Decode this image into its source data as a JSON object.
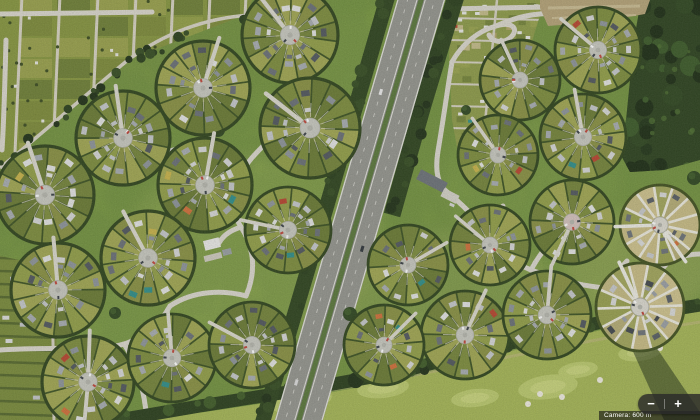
{
  "app": {
    "view": "satellite-aerial-view"
  },
  "map_controls": {
    "zoom_out_label": "−",
    "zoom_in_label": "+"
  },
  "attribution": {
    "text": "Camera: 600 m"
  },
  "palette": {
    "grass_base": "#7e9f40",
    "std": {
      "base": "#81913f",
      "wedges": [
        "#7e8e3d",
        "#93a048",
        "#6b7c34",
        "#a2a852",
        "#8a9243",
        "#75853a"
      ],
      "hedge": "#3c5222",
      "ring": "#2f441c",
      "plaza": "#c9cac1",
      "path": "#dcdacf",
      "inner": "rgba(224,220,198,0.7)",
      "houses": [
        "#c6c9cc",
        "#a8adb2",
        "#6a7077",
        "#e4e5e4",
        "#8e959b",
        "#51575e",
        "#d7d8d8"
      ],
      "accents": [
        "#b8452f",
        "#d2703a",
        "#2f8f8a",
        "#c9b44a"
      ]
    },
    "light": {
      "base": "#a8a468",
      "wedges": [
        "#b6ae76",
        "#c4ba82",
        "#a3a75c",
        "#d0c48e",
        "#99a150",
        "#c9bd85"
      ],
      "hedge": "#5a6a2e",
      "ring": "#41511f",
      "plaza": "#dcdad0",
      "path": "#eeede5",
      "spoke": "#edebdf",
      "inner": "rgba(238,235,223,0.8)",
      "houses": [
        "#585e64",
        "#9ba0a5",
        "#dadbda",
        "#42484e",
        "#c8cacc",
        "#6d7378"
      ],
      "accents": [
        "#b8452f",
        "#d2703a",
        "#2f8f8a"
      ]
    },
    "forest_base": "#2c421e",
    "forest_blobs": [
      "#223619",
      "#2f4720",
      "#3b5a28",
      "#1c2d14"
    ],
    "forest_light": "#4e7030",
    "tree_dark": [
      "#2a3f1c",
      "#354d22",
      "#203117"
    ],
    "road": "#dcd9cf",
    "asphalt": "#8c8d87",
    "lane": "#95968f",
    "median": "#5a783b",
    "white_line": "#e3e3dc",
    "dash_line": "#cfcfc8",
    "golf_base": "#a6b756",
    "golf_green": "#bccb6e",
    "golf_green_in": "#c9d57c",
    "bunker": "#f0ede1",
    "dirt": "#b6a478",
    "dirt_stripe": "#cbbd93",
    "shadow": "rgba(22,38,16,0.5)"
  },
  "scene": {
    "grass_patches": [
      [
        255,
        245,
        130,
        90,
        "#9cb553",
        0.55
      ],
      [
        450,
        300,
        110,
        70,
        "#a3b65a",
        0.5
      ],
      [
        640,
        265,
        75,
        55,
        "#b0bd60",
        0.6
      ],
      [
        90,
        330,
        80,
        50,
        "#8fae4b",
        0.5
      ],
      [
        530,
        180,
        90,
        60,
        "#8cab4a",
        0.45
      ],
      [
        170,
        60,
        120,
        50,
        "#7f9c40",
        0.4
      ],
      [
        620,
        390,
        90,
        40,
        "#9fb254",
        0.5
      ],
      [
        360,
        60,
        60,
        45,
        "#88a746",
        0.45
      ]
    ],
    "allotment_west": {
      "clip": "0,0 252,0 247,14 128,60 0,168",
      "cols": [
        16,
        54,
        92,
        130,
        167,
        204,
        240
      ],
      "row_step": 21,
      "plot_colors": [
        "#7e8c3a",
        "#93a047",
        "#6f8036",
        "#9aa24c",
        "#86953f"
      ],
      "base": "#87973f",
      "path_color": "#d8d4c4",
      "dot_color": "#3b4c20",
      "seed": 71
    },
    "allotment_east": {
      "clip": "452,0 545,0 536,28 518,90 500,150 488,172 462,174 452,120 449,55",
      "bbox": [
        449,
        0,
        96,
        174
      ],
      "hpaths": [
        18,
        40,
        62,
        84,
        106,
        128,
        150
      ],
      "base": "#8e9c49",
      "path_color": "#d6d2c2",
      "plot_colors": [
        "#75853a",
        "#99a44e",
        "#b4a86c",
        "#8a9847",
        "#c5bd8a",
        "#6d7c36"
      ],
      "roof_color": "#e9eae6",
      "seed": 72
    },
    "allotment_sw": {
      "clip": "0,256 48,266 56,300 58,420 0,420",
      "base": "#7a8c3b",
      "line_color": "#55682c",
      "seed": 73
    },
    "nw_corner": {
      "clip": "0,0 56,0 50,46 0,50",
      "base": "#5f7535",
      "seed": 74,
      "roofs": [
        [
          9,
          7,
          -10
        ],
        [
          25,
          5,
          8
        ],
        [
          41,
          9,
          -5
        ],
        [
          13,
          27,
          12
        ],
        [
          31,
          23,
          -8
        ]
      ]
    },
    "boundary_road": {
      "d": "M0,168 C46,130 96,86 128,60 C166,32 206,18 250,15",
      "pts": [
        [
          0,
          168
        ],
        [
          64,
          118
        ],
        [
          128,
          60
        ],
        [
          190,
          32
        ],
        [
          250,
          15
        ]
      ],
      "seed": 75
    },
    "roads_west": [
      "M0,350 C56,346 98,352 124,344 C152,335 162,320 170,306",
      "M124,344 C136,362 144,388 147,420",
      "M170,306 C194,290 224,290 246,296",
      "M246,296 C258,268 252,244 241,227 C231,211 229,196 236,181 C244,165 257,152 267,142 C277,130 279,112 271,97",
      "M241,227 C232,230 224,234 219,243",
      "M6,40 C5,80 4,120 2,150",
      "M152,12 L0,14"
    ],
    "roads_east": [
      "M452,62 C462,44 478,31 496,26 C511,21 519,28 512,36 C505,44 493,43 489,35",
      "M496,26 C520,15 545,11 566,15",
      "M452,62 C447,92 443,122 438,151 C435,170 437,184 447,192",
      "M447,192 C463,205 475,217 485,231 C497,249 511,262 531,270 C557,280 589,288 613,288 C637,288 656,277 669,261",
      "M531,270 C541,251 553,239 565,233",
      "M613,288 C616,276 621,267 627,261",
      "M485,231 C492,222 498,214 503,206",
      "M669,261 C681,256 692,254 700,254",
      "M447,9 L549,7"
    ],
    "tree_band": {
      "pts": [
        [
          112,
          421
        ],
        [
          200,
          406
        ],
        [
          300,
          390
        ],
        [
          400,
          372
        ],
        [
          466,
          354
        ],
        [
          540,
          336
        ],
        [
          620,
          318
        ],
        [
          700,
          305
        ]
      ],
      "w": 13,
      "seed": 76
    },
    "highway": {
      "x1": 424,
      "y1": -10,
      "x2": 296,
      "y2": 430,
      "west_strip": [
        [
          391,
          -15
        ],
        [
          327,
          205
        ],
        [
          262,
          424
        ]
      ],
      "east_strip": [
        [
          456,
          -4
        ],
        [
          423,
          105
        ],
        [
          392,
          215
        ]
      ],
      "seed": 77,
      "cars": [
        [
          0.24,
          -13,
          "#eeeeee"
        ],
        [
          0.58,
          13,
          "#2f353b"
        ],
        [
          0.9,
          -13,
          "#dddddd"
        ]
      ]
    },
    "forest": {
      "poly": "641,0 700,0 700,160 664,170 630,172 618,150 626,120 630,80 634,40",
      "bbox": [
        596,
        0,
        104,
        176
      ],
      "seed": 78
    },
    "dirt": {
      "poly": "540,0 650,0 645,14 600,22 548,26 540,8"
    },
    "tree_clumps": [
      [
        218,
        130,
        7
      ],
      [
        115,
        313,
        6
      ],
      [
        350,
        314,
        7
      ],
      [
        466,
        110,
        5
      ],
      [
        694,
        178,
        7
      ]
    ],
    "golf": {
      "poly": "104,420 205,412 305,397 405,379 470,361 545,343 623,325 700,311 700,420",
      "greens": [
        [
          300,
          400,
          32,
          13,
          -8
        ],
        [
          383,
          388,
          26,
          10,
          -6
        ],
        [
          548,
          387,
          30,
          12,
          -8
        ],
        [
          578,
          370,
          20,
          8,
          -8
        ],
        [
          640,
          352,
          22,
          9,
          -8
        ],
        [
          475,
          398,
          24,
          9,
          -6
        ]
      ],
      "bunkers": [
        [
          283,
          397
        ],
        [
          318,
          408
        ],
        [
          528,
          404
        ],
        [
          540,
          394
        ],
        [
          562,
          397
        ],
        [
          600,
          380
        ],
        [
          660,
          348
        ]
      ],
      "shadow_poly": "630,345 652,341 700,412 700,420 664,420",
      "sand_path": "M180,412 C260,402 340,390 430,372 C520,355 600,338 700,322"
    },
    "buildings": [
      [
        190,
        146,
        46,
        7,
        -17,
        "#dcdcd8"
      ],
      [
        196,
        156,
        40,
        6,
        -17,
        "#c3c5c7"
      ],
      [
        212,
        244,
        16,
        10,
        -14,
        "#ebebe9"
      ],
      [
        227,
        252,
        9,
        6,
        -14,
        "#9aa0a4"
      ],
      [
        213,
        257,
        18,
        6,
        -14,
        "#cfccc0"
      ],
      [
        432,
        181,
        30,
        11,
        27,
        "#6d7379"
      ],
      [
        450,
        196,
        17,
        9,
        27,
        "#d5d3c9"
      ]
    ],
    "cars": [
      [
        536,
        299,
        -10,
        "#ffffff"
      ],
      [
        560,
        287,
        -15,
        "#e8e8e8"
      ],
      [
        452,
        205,
        25,
        "#d8d8d8"
      ]
    ],
    "circles": [
      {
        "id": "w1",
        "cx": 203,
        "cy": 88,
        "r": 47,
        "style": "std",
        "seed": 11,
        "paths": [
          -72
        ]
      },
      {
        "id": "w2",
        "cx": 290,
        "cy": 35,
        "r": 48,
        "style": "std",
        "seed": 12,
        "paths": [
          -128
        ]
      },
      {
        "id": "w3",
        "cx": 123,
        "cy": 138,
        "r": 47,
        "style": "std",
        "seed": 13,
        "paths": [
          -98
        ]
      },
      {
        "id": "w4",
        "cx": 45,
        "cy": 195,
        "r": 49,
        "style": "std",
        "seed": 14,
        "paths": [
          -108
        ]
      },
      {
        "id": "w5",
        "cx": 205,
        "cy": 185,
        "r": 47,
        "style": "std",
        "seed": 15,
        "paths": [
          -80
        ]
      },
      {
        "id": "w6",
        "cx": 310,
        "cy": 128,
        "r": 50,
        "style": "std",
        "seed": 16,
        "paths": [
          -142
        ]
      },
      {
        "id": "w7",
        "cx": 148,
        "cy": 258,
        "r": 47,
        "style": "std",
        "seed": 17,
        "paths": [
          -118
        ]
      },
      {
        "id": "w8",
        "cx": 58,
        "cy": 290,
        "r": 47,
        "style": "std",
        "seed": 18,
        "paths": [
          -95
        ]
      },
      {
        "id": "w9",
        "cx": 88,
        "cy": 382,
        "r": 46,
        "style": "std",
        "seed": 19,
        "paths": [
          -88,
          95
        ]
      },
      {
        "id": "w10",
        "cx": 172,
        "cy": 358,
        "r": 44,
        "style": "std",
        "seed": 20,
        "paths": [
          -95
        ]
      },
      {
        "id": "w11",
        "cx": 252,
        "cy": 345,
        "r": 43,
        "style": "std",
        "seed": 21,
        "paths": [
          -152
        ]
      },
      {
        "id": "w12",
        "cx": 288,
        "cy": 230,
        "r": 43,
        "style": "std",
        "seed": 22,
        "paths": [
          -168
        ]
      },
      {
        "id": "e1",
        "cx": 520,
        "cy": 80,
        "r": 40,
        "style": "std",
        "seed": 31,
        "paths": [
          -115
        ]
      },
      {
        "id": "e2",
        "cx": 598,
        "cy": 50,
        "r": 43,
        "style": "std",
        "seed": 32,
        "paths": [
          -140
        ]
      },
      {
        "id": "e3",
        "cx": 583,
        "cy": 137,
        "r": 43,
        "style": "std",
        "seed": 33,
        "paths": [
          -100
        ]
      },
      {
        "id": "e4",
        "cx": 498,
        "cy": 155,
        "r": 40,
        "style": "std",
        "seed": 34,
        "paths": [
          -125
        ]
      },
      {
        "id": "e5",
        "cx": 572,
        "cy": 222,
        "r": 42,
        "style": "std",
        "seed": 35,
        "paths": [
          115
        ],
        "plaza": "#d6c4be"
      },
      {
        "id": "e6",
        "cx": 660,
        "cy": 225,
        "r": 40,
        "style": "light",
        "seed": 36,
        "paths": [
          178,
          55
        ]
      },
      {
        "id": "e7",
        "cx": 490,
        "cy": 245,
        "r": 40,
        "style": "std",
        "seed": 37,
        "paths": [
          -140
        ]
      },
      {
        "id": "e8",
        "cx": 408,
        "cy": 265,
        "r": 40,
        "style": "std",
        "seed": 38,
        "paths": [
          -30
        ]
      },
      {
        "id": "e9",
        "cx": 465,
        "cy": 335,
        "r": 44,
        "style": "std",
        "seed": 39,
        "paths": [
          -65
        ]
      },
      {
        "id": "e10",
        "cx": 547,
        "cy": 315,
        "r": 44,
        "style": "std",
        "seed": 40,
        "paths": [
          -85
        ]
      },
      {
        "id": "e11",
        "cx": 640,
        "cy": 307,
        "r": 44,
        "style": "light",
        "seed": 41,
        "paths": [
          -115
        ]
      },
      {
        "id": "e12",
        "cx": 384,
        "cy": 345,
        "r": 40,
        "style": "std",
        "seed": 42,
        "paths": [
          -45
        ]
      }
    ]
  }
}
